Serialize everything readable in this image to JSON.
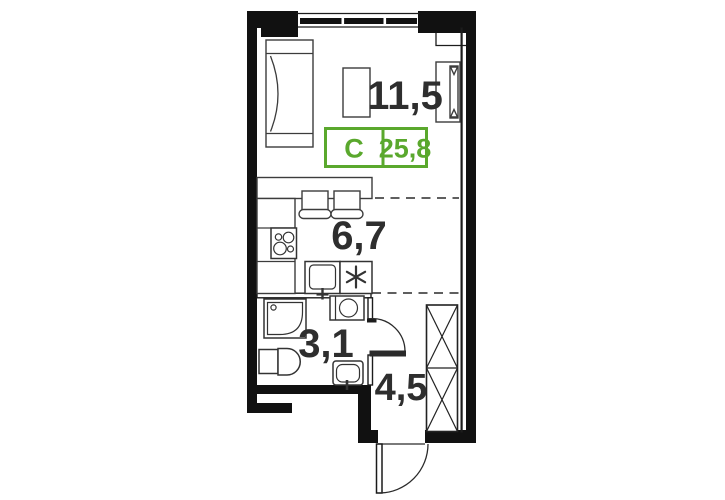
{
  "badge": {
    "color": "#5aa82d",
    "type_label": "C",
    "total_area": "25,8"
  },
  "rooms": {
    "living": "11,5",
    "kitchen": "6,7",
    "bathroom": "3,1",
    "hallway": "4,5"
  }
}
